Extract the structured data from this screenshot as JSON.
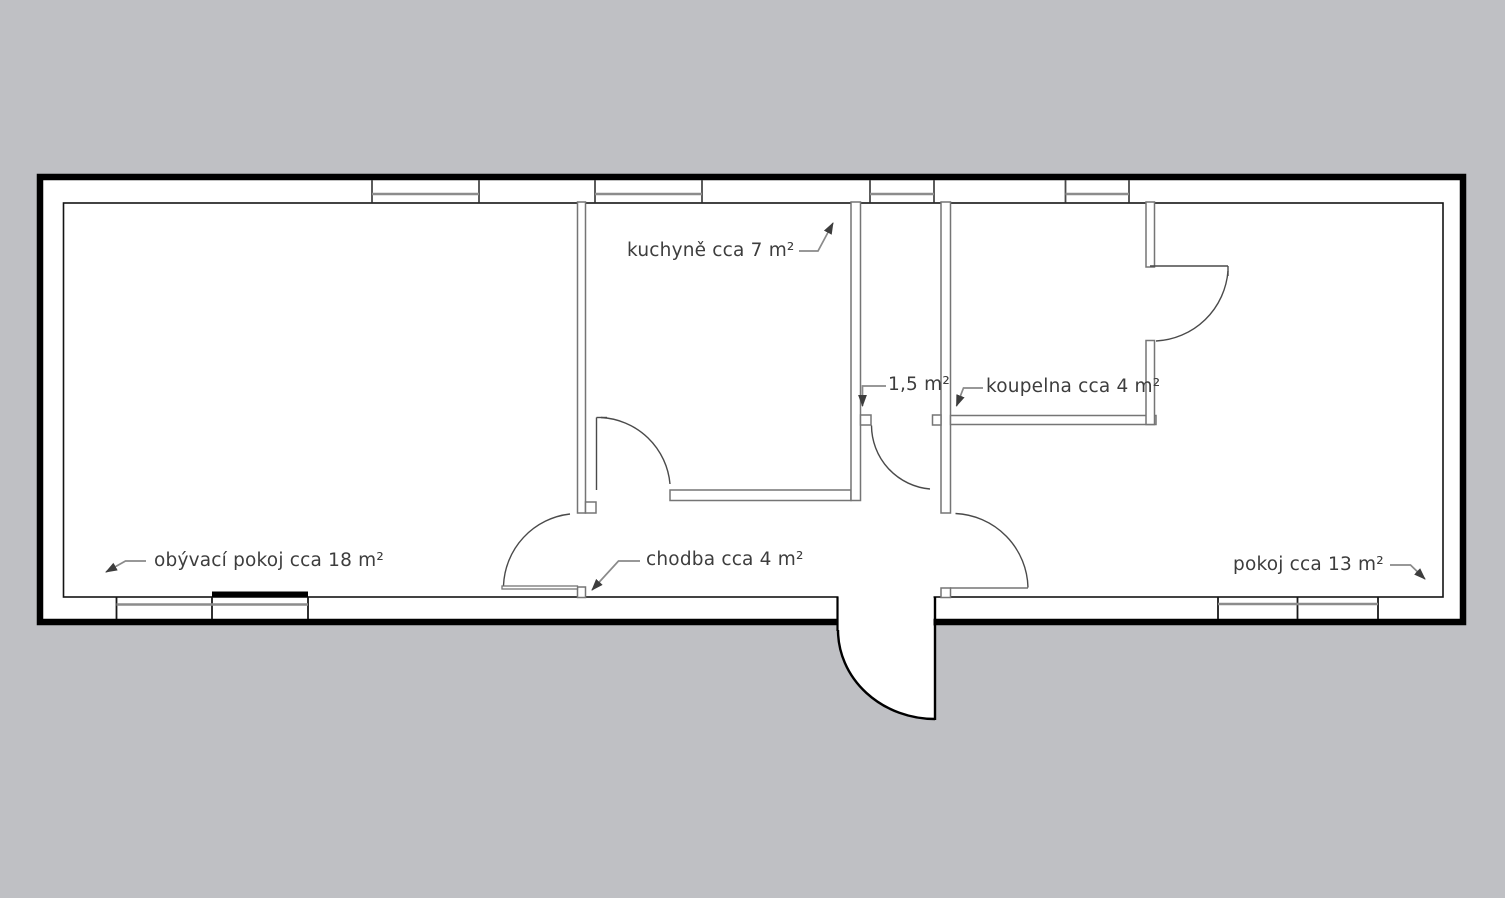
{
  "floor_plan": {
    "colors": {
      "background": "#bfc0c4",
      "plan_fill": "#ffffff",
      "outer_wall": "#000000",
      "partition_wall": "#757575",
      "window_line": "#8c8c8c",
      "door_arc": "#4a4a4a",
      "label_text": "#3d3d3d",
      "leader_line": "#8a8a8a",
      "balcony_door_marker": "#000000"
    },
    "rooms": [
      {
        "id": "living-room",
        "label": "obývací pokoj cca 18 m²"
      },
      {
        "id": "kitchen",
        "label": "kuchyně cca 7 m²"
      },
      {
        "id": "hallway",
        "label": "chodba cca 4 m²"
      },
      {
        "id": "wc",
        "label": "1,5 m²"
      },
      {
        "id": "bathroom",
        "label": "koupelna cca 4 m²"
      },
      {
        "id": "bedroom",
        "label": "pokoj cca 13 m²"
      }
    ]
  }
}
